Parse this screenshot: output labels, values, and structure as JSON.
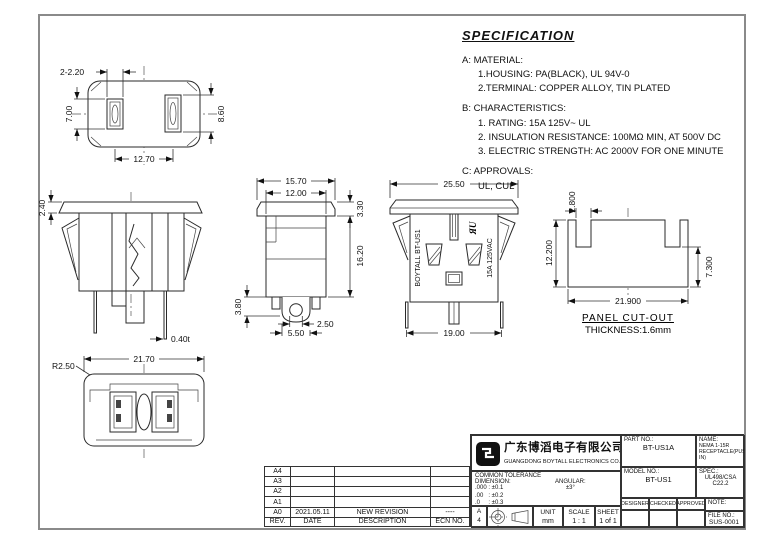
{
  "spec": {
    "title": "SPECIFICATION",
    "sections": [
      {
        "label": "A:",
        "heading": "MATERIAL:",
        "lines": [
          "1.HOUSING: PA(BLACK), UL 94V-0",
          "2.TERMINAL: COPPER ALLOY, TIN PLATED"
        ]
      },
      {
        "label": "B:",
        "heading": "CHARACTERISTICS:",
        "lines": [
          "1. RATING: 15A 125V~ UL",
          "2. INSULATION RESISTANCE: 100MΩ MIN, AT 500V DC",
          "3. ELECTRIC STRENGTH: AC 2000V FOR ONE MINUTE"
        ]
      },
      {
        "label": "C:",
        "heading": "APPROVALS:",
        "lines": [
          "UL, CUL"
        ]
      }
    ]
  },
  "views": {
    "front_face": {
      "slot_width": "2-2.20",
      "left_slot_height": "7.00",
      "right_slot_height": "8.60",
      "slot_pitch": "12.70"
    },
    "section": {
      "flange_thickness": "2.40",
      "terminal_thickness": "0.40t"
    },
    "side": {
      "flange_width": "15.70",
      "body_width": "12.00",
      "flange_height": "3.30",
      "body_height": "16.20",
      "foot_height": "3.80",
      "hole_diameter": "2.50",
      "tab_width": "5.50"
    },
    "rear": {
      "flange_width": "25.50",
      "pin_pitch": "19.00",
      "marking_left": "BOYTALL  BT-US1",
      "marking_right": "15A 125VAC",
      "ul_mark": "ЯU"
    },
    "panel_cutout": {
      "notch_width": "2.800",
      "total_height": "12.200",
      "side_height": "7.300",
      "width": "21.900",
      "title": "PANEL CUT-OUT",
      "thickness_note": "THICKNESS:1.6mm"
    },
    "bottom": {
      "width": "21.70",
      "corner_radius": "R2.50"
    }
  },
  "revision_table": {
    "rows": [
      {
        "rev": "A4",
        "date": "",
        "description": "",
        "ecn": ""
      },
      {
        "rev": "A3",
        "date": "",
        "description": "",
        "ecn": ""
      },
      {
        "rev": "A2",
        "date": "",
        "description": "",
        "ecn": ""
      },
      {
        "rev": "A1",
        "date": "",
        "description": "",
        "ecn": ""
      },
      {
        "rev": "A0",
        "date": "2021.05.11",
        "description": "NEW REVISION",
        "ecn": "----"
      }
    ],
    "header": {
      "rev": "REV.",
      "date": "DATE",
      "description": "DESCRIPTION",
      "ecn": "ECN NO."
    }
  },
  "title_block": {
    "company_cn": "广东博滔电子有限公司",
    "company_en": "GUANGDONG BOYTALL ELECTRONICS CO.,LTD",
    "tolerance": {
      "title": "COMMON TOLERANCE",
      "dimension_label": "DIMENSION:",
      "angular_label": "ANGULAR:",
      "dim_rows": [
        ".000 : ±0.1",
        ".00   : ±0.2",
        ".0     : ±0.3"
      ],
      "angular_value": "±3°"
    },
    "paper_letter": "A",
    "paper_number": "4",
    "unit_label": "UNIT",
    "unit_value": "mm",
    "scale_label": "SCALE",
    "scale_value": "1 : 1",
    "sheet_label": "SHEET",
    "sheet_value": "1 of 1",
    "part_label": "PART NO.:",
    "part_value": "BT-US1A",
    "name_label": "NAME:",
    "name_line1": "NEMA 1-15R",
    "name_line2": "RECEPTACLE(PUSH-IN)",
    "model_label": "MODEL NO.:",
    "model_value": "BT-US1",
    "spec_label": "SPEC.:",
    "spec_value": "UL498/CSA C22.2",
    "designer_label": "DESIGNER",
    "checked_label": "CHECKED",
    "approved_label": "APPROVED",
    "note_label": "NOTE:",
    "file_label": "FILE NO.:",
    "file_value": "SUS-0001"
  }
}
